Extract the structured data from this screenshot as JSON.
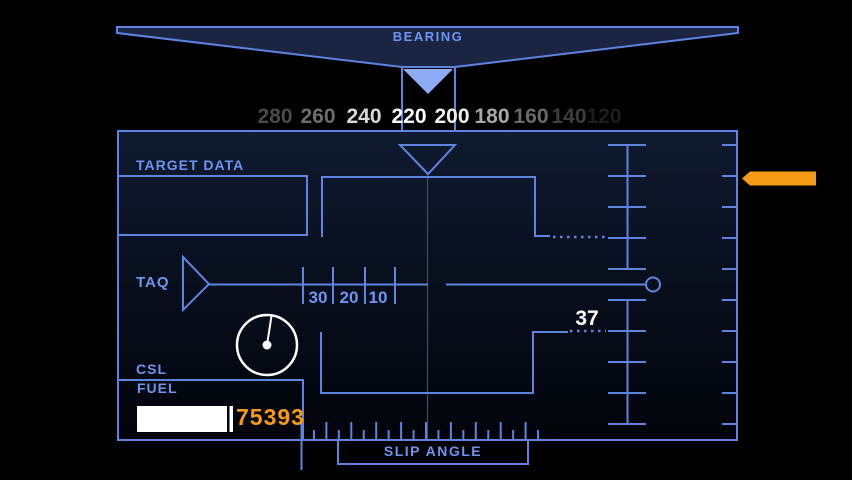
{
  "colors": {
    "line": "#5C84E0",
    "label": "#6C96F2",
    "orange": "#F79B16",
    "white": "#FFFFFF",
    "bowtie_fill": "#1B2542",
    "pointer_fill": "#8FACF8",
    "dim_line": "#3F4C68",
    "panel_top": "#101A30",
    "panel_bottom": "#020409"
  },
  "bearing": {
    "label": "BEARING",
    "current_value": "220",
    "scale": [
      {
        "value": "280",
        "x": 275,
        "color": "#4A4A4A"
      },
      {
        "value": "260",
        "x": 318,
        "color": "#6E6E6E"
      },
      {
        "value": "240",
        "x": 364,
        "color": "#D8D8D8"
      },
      {
        "value": "220",
        "x": 409,
        "color": "#FFFFFF"
      },
      {
        "value": "200",
        "x": 452,
        "color": "#F0F0F0"
      },
      {
        "value": "180",
        "x": 492,
        "color": "#A8A8A8"
      },
      {
        "value": "160",
        "x": 531,
        "color": "#6A6A6A"
      },
      {
        "value": "140",
        "x": 569,
        "color": "#3E3E3E"
      },
      {
        "value": "120",
        "x": 604,
        "color": "#1E1E1E"
      }
    ]
  },
  "panel": {
    "target_data_label": "TARGET DATA",
    "taq": {
      "label": "TAQ",
      "tick_labels": [
        "30",
        "20",
        "10"
      ]
    },
    "range_value": "37",
    "csl_label": "CSL",
    "fuel": {
      "label": "FUEL",
      "value": "75393"
    },
    "slip_angle_label": "SLIP ANGLE"
  },
  "icons": {
    "bearing_pointer": "filled-down-triangle",
    "center_marker": "outlined-down-triangle",
    "taq_pointer": "outlined-right-triangle",
    "range_cursor": "orange-left-arrow",
    "clock_gauge": "white-dial-with-needle"
  }
}
